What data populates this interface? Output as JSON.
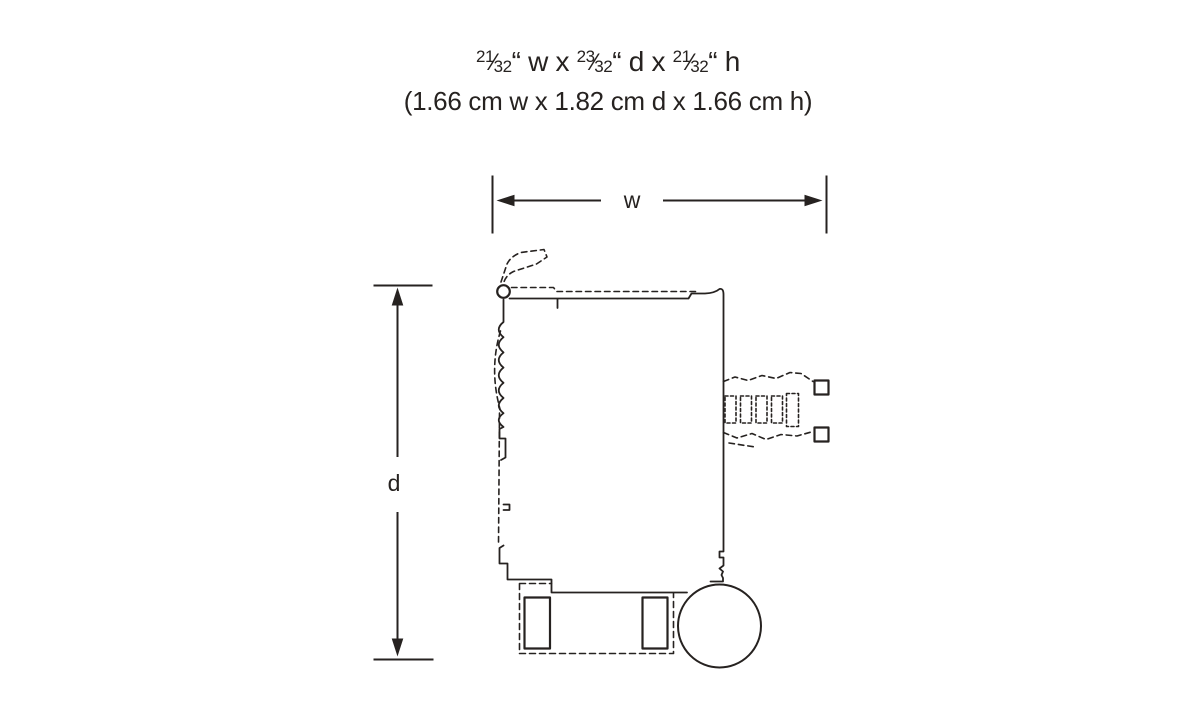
{
  "heading": {
    "frac_slash": "⁄",
    "imperial": {
      "w_num": "21",
      "w_den": "32",
      "w_sep": "“ w x ",
      "d_num": "23",
      "d_den": "32",
      "d_sep": "“ d x ",
      "h_num": "21",
      "h_den": "32",
      "h_sep": "“ h"
    },
    "metric": "(1.66 cm w x 1.82 cm d x 1.66 cm h)"
  },
  "diagram": {
    "width_label": "w",
    "depth_label": "d"
  },
  "colors": {
    "ink": "#262220",
    "background": "#ffffff"
  }
}
